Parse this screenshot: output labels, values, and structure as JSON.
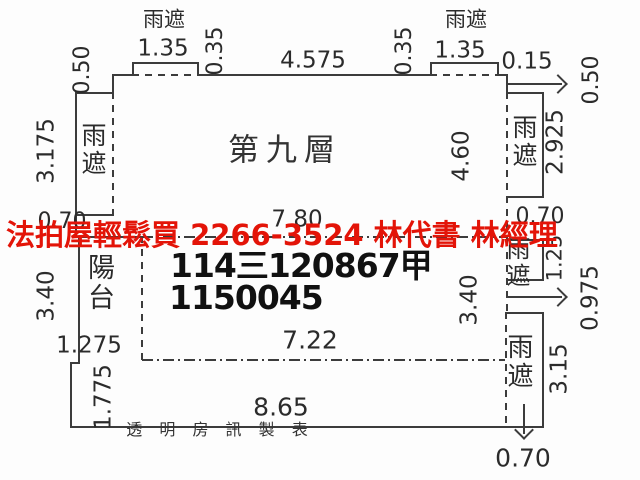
{
  "overlay": {
    "ad_text": "法拍屋輕鬆買  2266-3524  林代書 林經理",
    "ad_color": "#e31408"
  },
  "plan": {
    "floor_label": "第九層",
    "case_number_line1": "114三120867甲",
    "case_number_line2": "1150045",
    "maker_credit": "透 明 房 訊 製 表",
    "rooms": {
      "canopy": "雨遮",
      "balcony": "陽台"
    },
    "dims": {
      "top_left_canopy_w": "1.35",
      "top_left_canopy_h": "0.35",
      "top_left_step": "0.50",
      "top_width": "4.575",
      "top_right_canopy_h": "0.35",
      "top_right_canopy_w": "1.35",
      "right_offset": "0.15",
      "right_step": "0.50",
      "left_canopy_h": "3.175",
      "left_canopy_w": "0.70",
      "main_width": "7.80",
      "main_height_right": "4.60",
      "right_canopy_h": "2.925",
      "right_canopy_w": "0.70",
      "left_mid_h": "3.40",
      "mid_height_right": "3.40",
      "mid_width": "7.22",
      "balcony_w": "1.275",
      "right_mid_canopy_h": "1.25",
      "right_step2": "0.975",
      "bottom_h": "1.775",
      "bottom_w": "8.65",
      "right_bottom_canopy_h": "3.15",
      "right_bottom_canopy_w": "0.70"
    }
  },
  "colors": {
    "line": "#3c3c3c",
    "text": "#2b2b2b",
    "background": "#ffffff"
  }
}
